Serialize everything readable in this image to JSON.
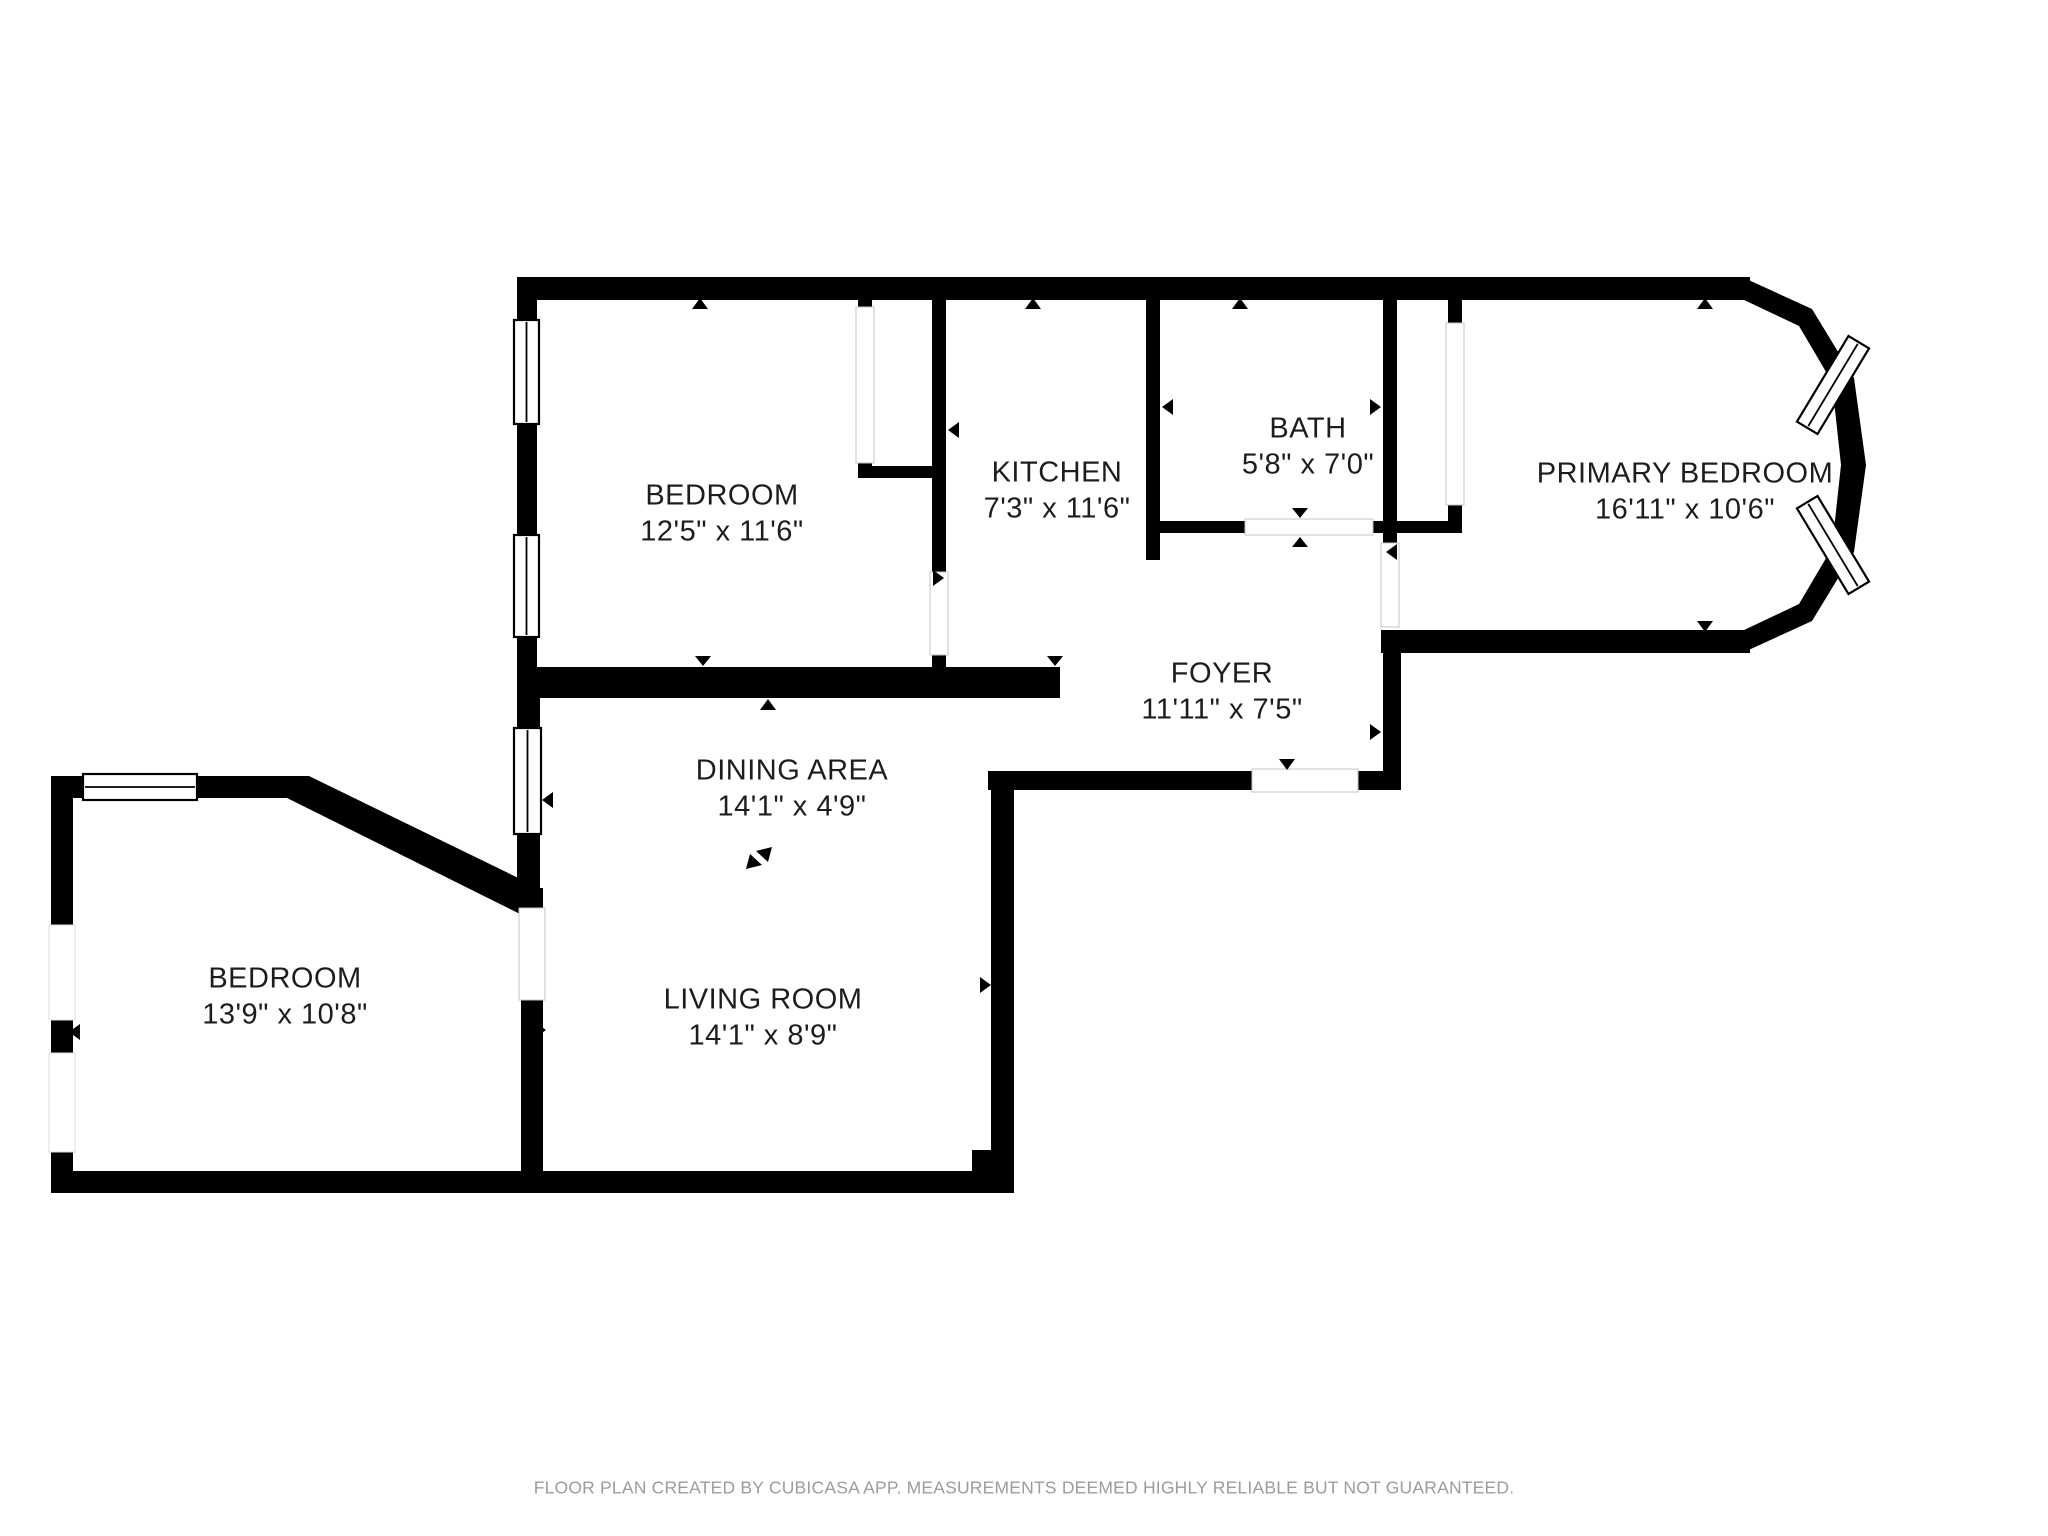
{
  "plan": {
    "rooms": [
      {
        "name": "BEDROOM",
        "dimensions": "12'5\" x 11'6\""
      },
      {
        "name": "KITCHEN",
        "dimensions": "7'3\" x 11'6\""
      },
      {
        "name": "BATH",
        "dimensions": "5'8\" x 7'0\""
      },
      {
        "name": "PRIMARY BEDROOM",
        "dimensions": "16'11\" x 10'6\""
      },
      {
        "name": "FOYER",
        "dimensions": "11'11\" x 7'5\""
      },
      {
        "name": "DINING AREA",
        "dimensions": "14'1\" x 4'9\""
      },
      {
        "name": "LIVING ROOM",
        "dimensions": "14'1\" x 8'9\""
      },
      {
        "name": "BEDROOM",
        "dimensions": "13'9\" x 10'8\""
      }
    ],
    "footer": "FLOOR PLAN CREATED BY CUBICASA APP. MEASUREMENTS DEEMED HIGHLY RELIABLE BUT NOT GUARANTEED.",
    "colors": {
      "wall": "#000000",
      "background": "#ffffff",
      "label": "#1d1d1d",
      "footer": "#9c9c9c"
    }
  }
}
